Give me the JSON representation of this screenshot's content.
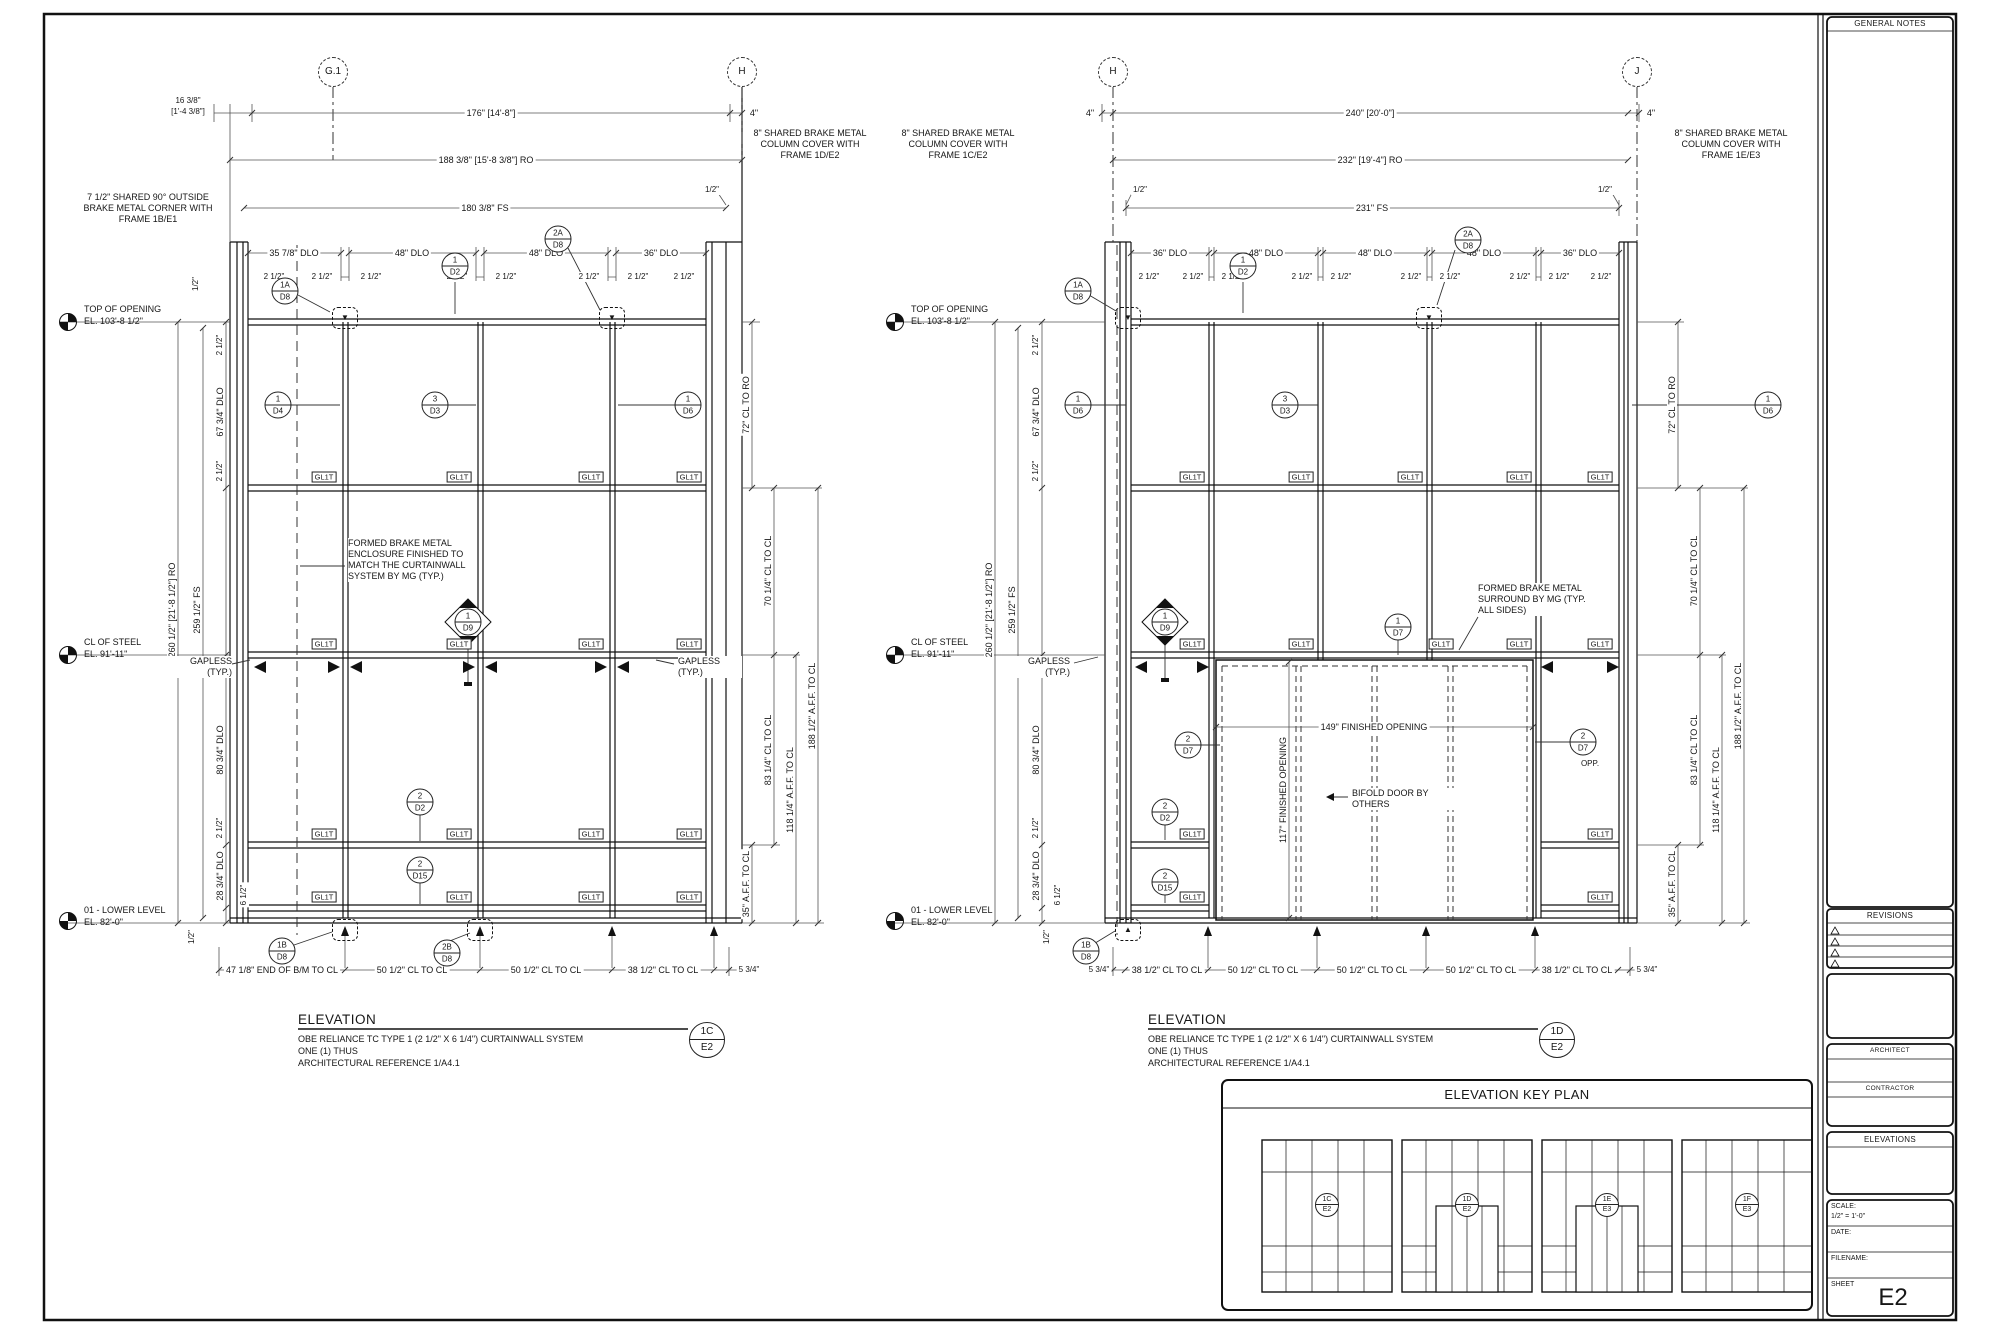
{
  "titleblock": {
    "general_notes": "GENERAL NOTES",
    "revisions": "REVISIONS",
    "architect": "ARCHITECT",
    "contractor": "CONTRACTOR",
    "elevations": "ELEVATIONS",
    "scale_label": "SCALE:",
    "scale_value": "1/2\" = 1'-0\"",
    "date_label": "DATE:",
    "filename_label": "FILENAME:",
    "sheet_label": "SHEET",
    "sheet_number": "E2"
  },
  "key_plan": {
    "title": "ELEVATION KEY PLAN",
    "callouts": [
      [
        "1C",
        "E2"
      ],
      [
        "1D",
        "E2"
      ],
      [
        "1E",
        "E3"
      ],
      [
        "1F",
        "E3"
      ]
    ]
  },
  "common": {
    "gl_tag": "GL1T",
    "gapless_1": "GAPLESS",
    "gapless_2": "(TYP.)",
    "dim_2_5": "2 1/2\"",
    "dim_half": "1/2\"",
    "dim_4": "4\"",
    "anchor_down": "▼",
    "anchor_up": "▲",
    "levels": [
      {
        "name": "TOP OF OPENING",
        "el": "EL. 103'-8 1/2\""
      },
      {
        "name": "CL OF STEEL",
        "el": "EL. 91'-11\""
      },
      {
        "name": "01 - LOWER LEVEL",
        "el": "EL. 82'-0\""
      }
    ],
    "vchain": {
      "ro": "260 1/2\" [21'-8 1/2\"] RO",
      "fs": "259 1/2\" FS",
      "dlo_top": "67 3/4\" DLO",
      "dlo_mid": "80 3/4\" DLO",
      "dlo_bot": "28 3/4\" DLO",
      "sill": "6 1/2\""
    },
    "rchain": {
      "cl_to_ro": "72\" CL TO RO",
      "cl70": "70 1/4\" CL TO CL",
      "cl83": "83 1/4\" CL TO CL",
      "aff35": "35\" A.F.F. TO CL",
      "aff118": "118 1/4\" A.F.F. TO CL",
      "aff188": "188 1/2\" A.F.F. TO CL"
    },
    "title_word": "ELEVATION",
    "title_line1": "OBE RELIANCE TC TYPE 1 (2 1/2\" X 6 1/4\") CURTAINWALL SYSTEM",
    "title_line2": "ONE (1) THUS",
    "title_line3": "ARCHITECTURAL REFERENCE 1/A4.1"
  },
  "left": {
    "grids": [
      "G.1",
      "H"
    ],
    "corner_note": "7 1/2\" SHARED 90° OUTSIDE BRAKE METAL CORNER WITH FRAME 1B/E1",
    "column_note": "8\" SHARED BRAKE METAL COLUMN COVER WITH FRAME 1D/E2",
    "enclosure_note": "FORMED BRAKE METAL ENCLOSURE FINISHED TO MATCH THE CURTAINWALL SYSTEM BY MG (TYP.)",
    "dim_16": "16 3/8\"",
    "dim_16b": "[1'-4 3/8\"]",
    "dim_176": "176\" [14'-8\"]",
    "dim_ro": "188 3/8\" [15'-8 3/8\"] RO",
    "dim_fs": "180 3/8\" FS",
    "dlos": [
      "35 7/8\" DLO",
      "48\" DLO",
      "48\" DLO",
      "36\" DLO"
    ],
    "bottom_dims": [
      "47 1/8\" END OF B/M TO CL",
      "50 1/2\" CL TO CL",
      "50 1/2\" CL TO CL",
      "38 1/2\" CL TO CL",
      "5 3/4\""
    ],
    "callout": [
      "1C",
      "E2"
    ]
  },
  "right": {
    "grids": [
      "H",
      "J"
    ],
    "column_note_left": "8\" SHARED BRAKE METAL COLUMN COVER WITH FRAME 1C/E2",
    "column_note_right": "8\" SHARED BRAKE METAL COLUMN COVER WITH FRAME 1E/E3",
    "surround_note": "FORMED BRAKE METAL SURROUND BY MG (TYP. ALL SIDES)",
    "bifold_note": "BIFOLD DOOR BY OTHERS",
    "fo_149": "149\" FINISHED OPENING",
    "fo_117": "117\" FINISHED OPENING",
    "dim_240": "240\" [20'-0\"]",
    "dim_ro": "232\" [19'-4\"] RO",
    "dim_fs": "231\" FS",
    "dlos": [
      "36\" DLO",
      "48\" DLO",
      "48\" DLO",
      "48\" DLO",
      "36\" DLO"
    ],
    "bottom_dims": [
      "5 3/4\"",
      "38 1/2\" CL TO CL",
      "50 1/2\" CL TO CL",
      "50 1/2\" CL TO CL",
      "50 1/2\" CL TO CL",
      "38 1/2\" CL TO CL",
      "5 3/4\""
    ],
    "callout": [
      "1D",
      "E2"
    ],
    "opp": "OPP."
  },
  "callouts": {
    "c1a_d8": [
      "1A",
      "D8"
    ],
    "c1_d2": [
      "1",
      "D2"
    ],
    "c2a_d8": [
      "2A",
      "D8"
    ],
    "c1_d4": [
      "1",
      "D4"
    ],
    "c3_d3": [
      "3",
      "D3"
    ],
    "c1_d6": [
      "1",
      "D6"
    ],
    "c1_d9": [
      "1",
      "D9"
    ],
    "c2_d2": [
      "2",
      "D2"
    ],
    "c2_d15": [
      "2",
      "D15"
    ],
    "c1b_d8": [
      "1B",
      "D8"
    ],
    "c2b_d8": [
      "2B",
      "D8"
    ],
    "c1_d7": [
      "1",
      "D7"
    ],
    "c2_d7": [
      "2",
      "D7"
    ]
  }
}
